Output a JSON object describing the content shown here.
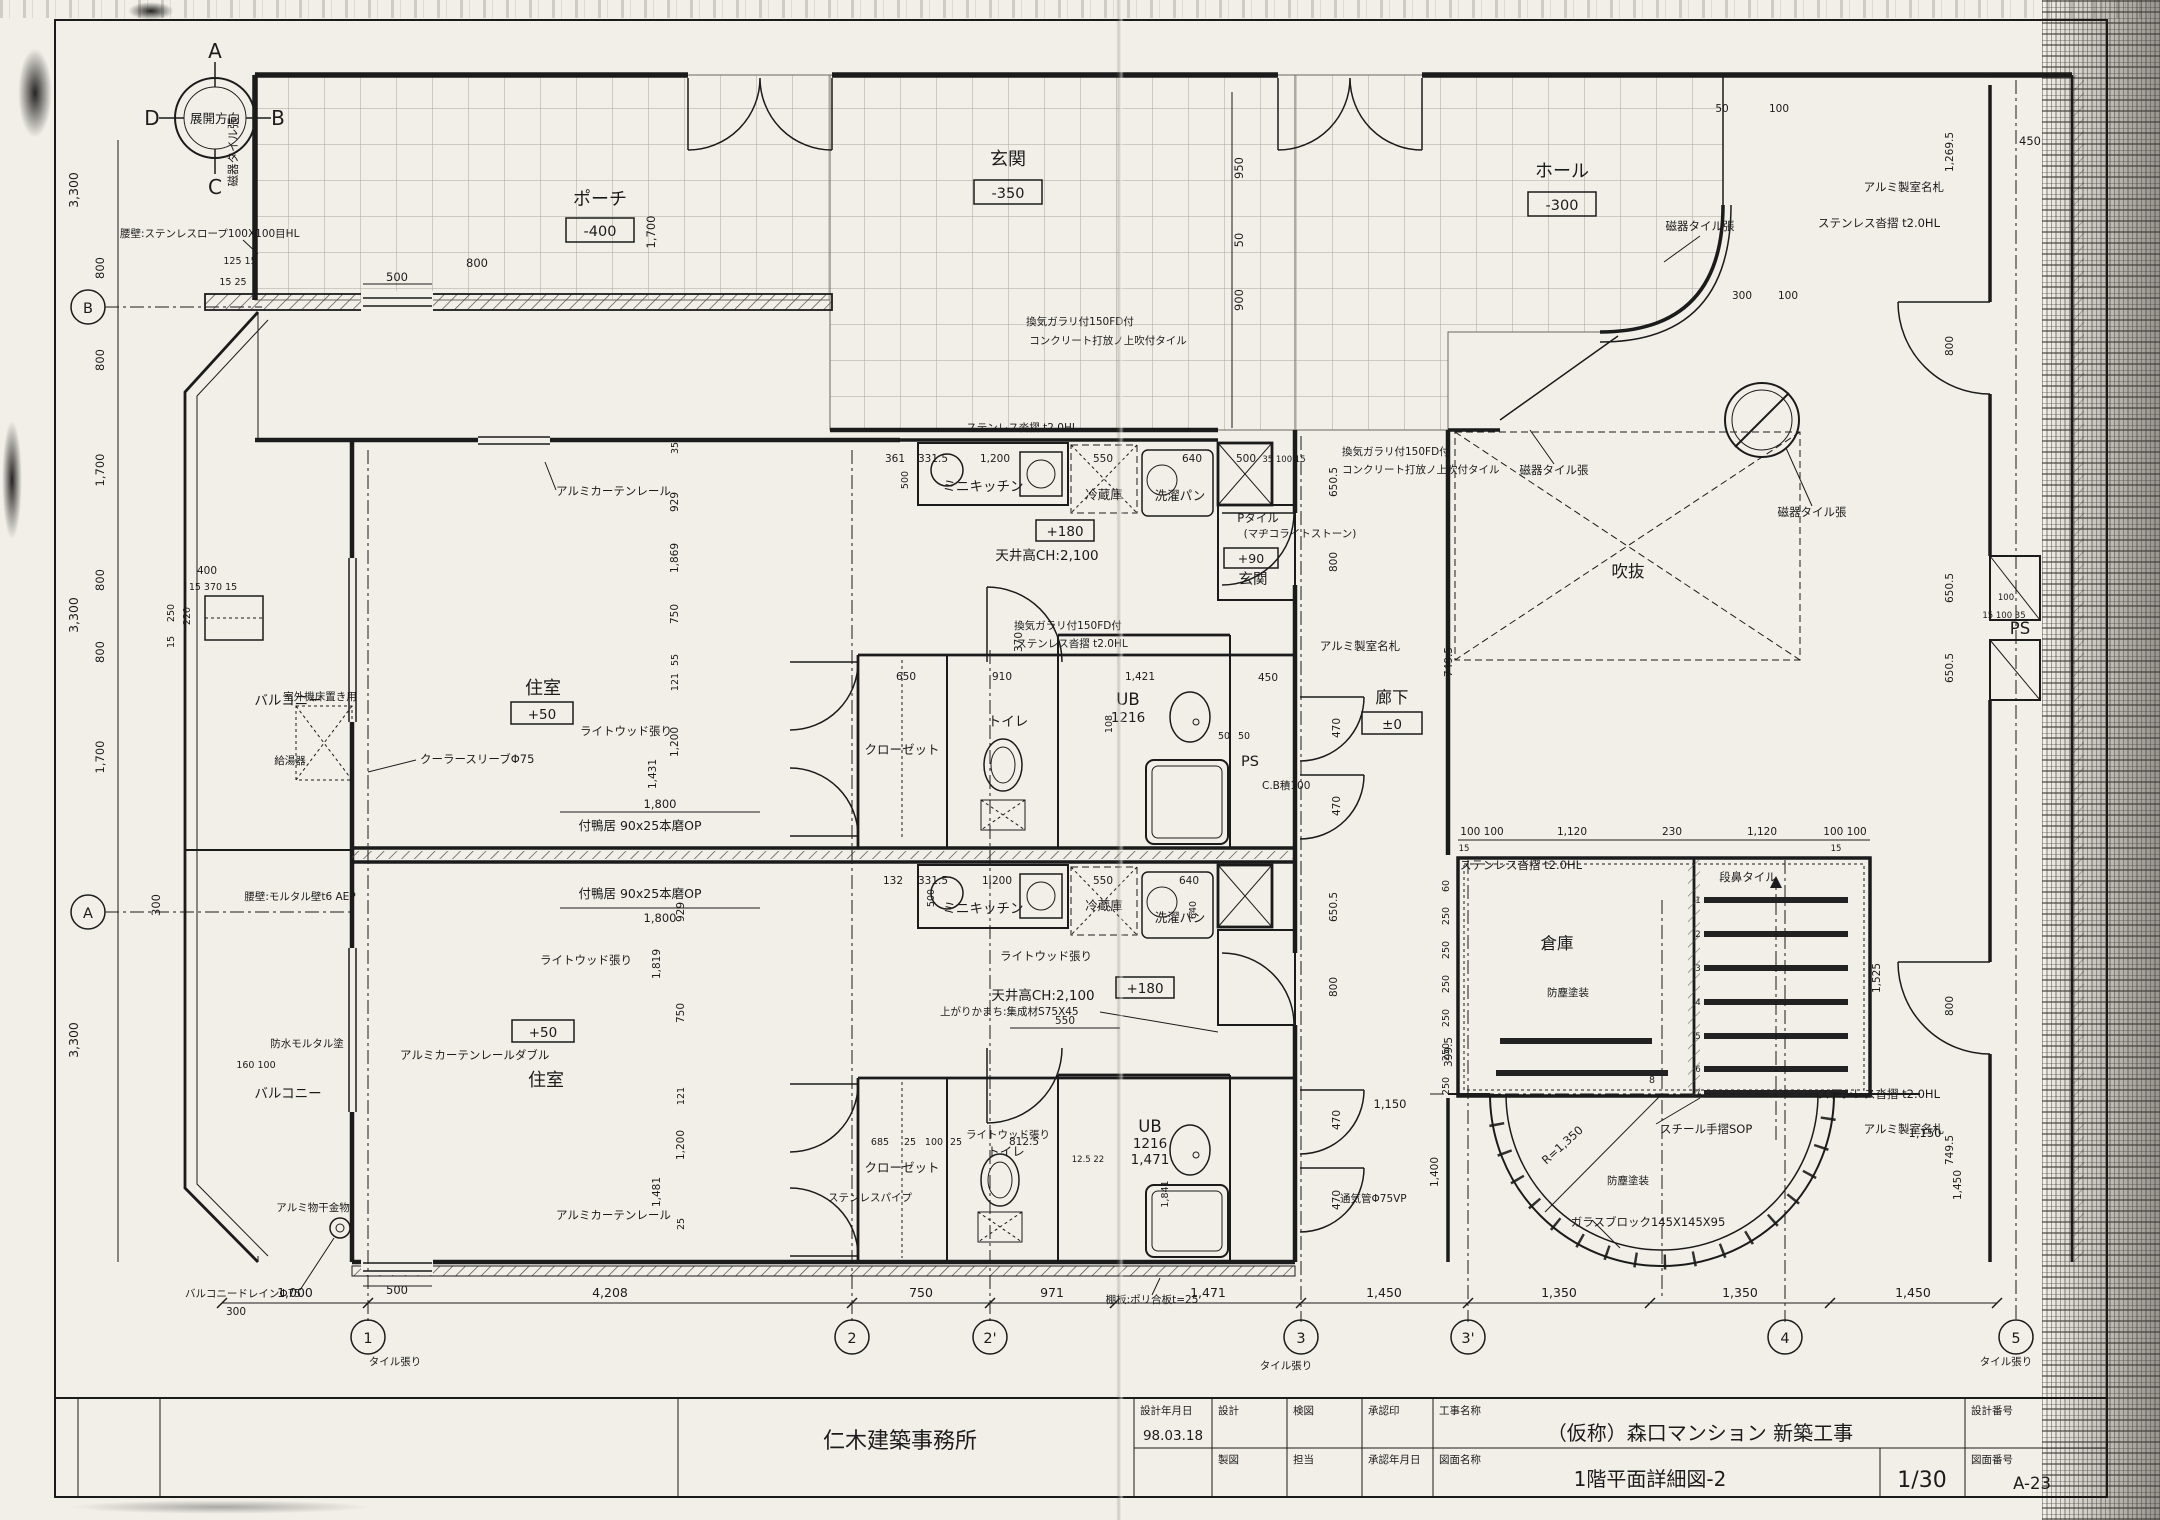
{
  "title_block": {
    "company": "仁木建築事務所",
    "design_date_label": "設計年月日",
    "design_date": "98.03.18",
    "design_label": "設計",
    "check_label": "検図",
    "approval_label": "承認印",
    "project_label": "工事名称",
    "project_name": "（仮称）森口マンション 新築工事",
    "design_no_label": "設計番号",
    "draft_label": "製図",
    "charge_label": "担当",
    "approval_date_label": "承認年月日",
    "drawing_label": "図面名称",
    "drawing_name": "1階平面詳細図-2",
    "scale": "1/30",
    "drawing_no_label": "図面番号",
    "drawing_no": "A-23"
  },
  "compass": {
    "center": "展開方向",
    "top": "A",
    "right": "B",
    "bottom": "C",
    "left": "D"
  },
  "grid": {
    "bottom_bubbles": [
      "1",
      "2",
      "2'",
      "3",
      "3'",
      "4",
      "5"
    ],
    "bottom_dims": [
      "1,000",
      "4,208",
      "750",
      "971",
      "1,471",
      "1,450",
      "1,350",
      "1,350",
      "1,450"
    ],
    "left_bubbles": [
      "B",
      "A"
    ],
    "left_outer": [
      "3,300",
      "3,300",
      "3,300"
    ],
    "left_inner": [
      "800",
      "800",
      "1,700",
      "800",
      "800",
      "1,700",
      "300"
    ],
    "left_cluster": [
      "400",
      "15 370 15",
      "250",
      "220",
      "15",
      "160 100"
    ]
  },
  "rooms": {
    "porch": "ポーチ",
    "porch_level": "-400",
    "entrance": "玄関",
    "entrance_level": "-350",
    "hall": "ホール",
    "hall_level": "-300",
    "living": "住室",
    "living_level": "+50",
    "balcony": "バルコニー",
    "closet": "クローゼット",
    "toilet": "トイレ",
    "ub": "UB",
    "ub_size": "1216",
    "ub_width": "1,471",
    "unit_entrance": "玄関",
    "unit_entrance_level": "+90",
    "corridor": "廊下",
    "corridor_level": "±0",
    "ps": "PS",
    "storage": "倉庫",
    "void": "吹抜",
    "mini_kitchen": "ミニキッチン",
    "fridge": "冷蔵庫",
    "laundry_pan": "洗濯パン",
    "kitchen_level": "+180"
  },
  "notes": {
    "ceiling": "天井高CH:2,100",
    "curtain_rail": "アルミカーテンレール",
    "curtain_rail_double": "アルミカーテンレールダブル",
    "light_wood": "ライトウッド張り",
    "cooler_sleeve": "クーラースリーブΦ75",
    "outdoor_unit": "室外機床置き用",
    "water_heater": "給湯器",
    "kamoi": "付鴨居 90x25本磨OP",
    "partition_wall": "腰壁:モルタル壁t6 AEP",
    "waterproof": "防水モルタル塗",
    "hanger": "アルミ物干金物",
    "drain": "バルコニードレインΦ75",
    "tile": "タイル張り",
    "shelf": "棚板:ポリ合板t=25",
    "ss_pipe": "ステンレスパイプ",
    "agari": "上がりかまち:集成材S75X45",
    "louver": "換気ガラリ付150FD付",
    "concrete": "コンクリート打放ノ上吹付タイル",
    "p_tile": "Pタイル",
    "p_tile2": "(マヂコライトストーン)",
    "kutsuzuri": "ステンレス沓摺 t2.0HL",
    "nameplate": "アルミ製室名札",
    "porcelain": "磁器タイル張",
    "cb": "C.B積100",
    "nosing": "段鼻タイル",
    "dust_paint": "防塵塗装",
    "handrail": "スチール手摺SOP",
    "glass_block": "ガラスブロック145X145X95",
    "radius": "R=1,350",
    "vent_pipe": "通気管Φ75VP",
    "parapet": "腰壁:ステンレスロープ100X100目HL"
  },
  "dims": {
    "top": [
      "1,700",
      "950",
      "50",
      "900",
      "125 15",
      "15 25",
      "500",
      "800",
      "50",
      "100",
      "300",
      "100",
      "450"
    ],
    "upper_kitchen": [
      "361",
      "331.5",
      "1,200",
      "550",
      "640",
      "500",
      "500",
      "35 100 15",
      "650.5",
      "800"
    ],
    "lower_kitchen": [
      "132",
      "331.5",
      "1,200",
      "550",
      "640",
      "500",
      "640",
      "650.5",
      "800"
    ],
    "upper_bath": [
      "650",
      "910",
      "370",
      "1,421",
      "108",
      "50",
      "50",
      "450"
    ],
    "lower_bath": [
      "685",
      "25",
      "100",
      "25",
      "812.5",
      "12.5 22",
      "1,841",
      "550"
    ],
    "west_upper": [
      "35",
      "929",
      "1,869",
      "750",
      "55",
      "121",
      "1,200",
      "1,431"
    ],
    "west_lower": [
      "929",
      "1,819",
      "750",
      "121",
      "1,200",
      "1,481",
      "25"
    ],
    "corridor": [
      "749.5",
      "470",
      "470",
      "470",
      "470",
      "399.5",
      "1,150",
      "1,400",
      "1,150",
      "1,450"
    ],
    "stairs": [
      "100 100",
      "1,120",
      "230",
      "1,120",
      "100 100",
      "15",
      "15",
      "60",
      "250",
      "250",
      "250",
      "250",
      "250",
      "250",
      "1,525"
    ],
    "right": [
      "1,269.5",
      "800",
      "650.5",
      "15 100 35",
      "100",
      "650.5",
      "800",
      "749.5"
    ],
    "south": [
      "500",
      "300"
    ],
    "party": [
      "1,800",
      "1,800"
    ]
  },
  "stair_steps": [
    "1",
    "2",
    "3",
    "4",
    "5",
    "6",
    "7",
    "8"
  ]
}
